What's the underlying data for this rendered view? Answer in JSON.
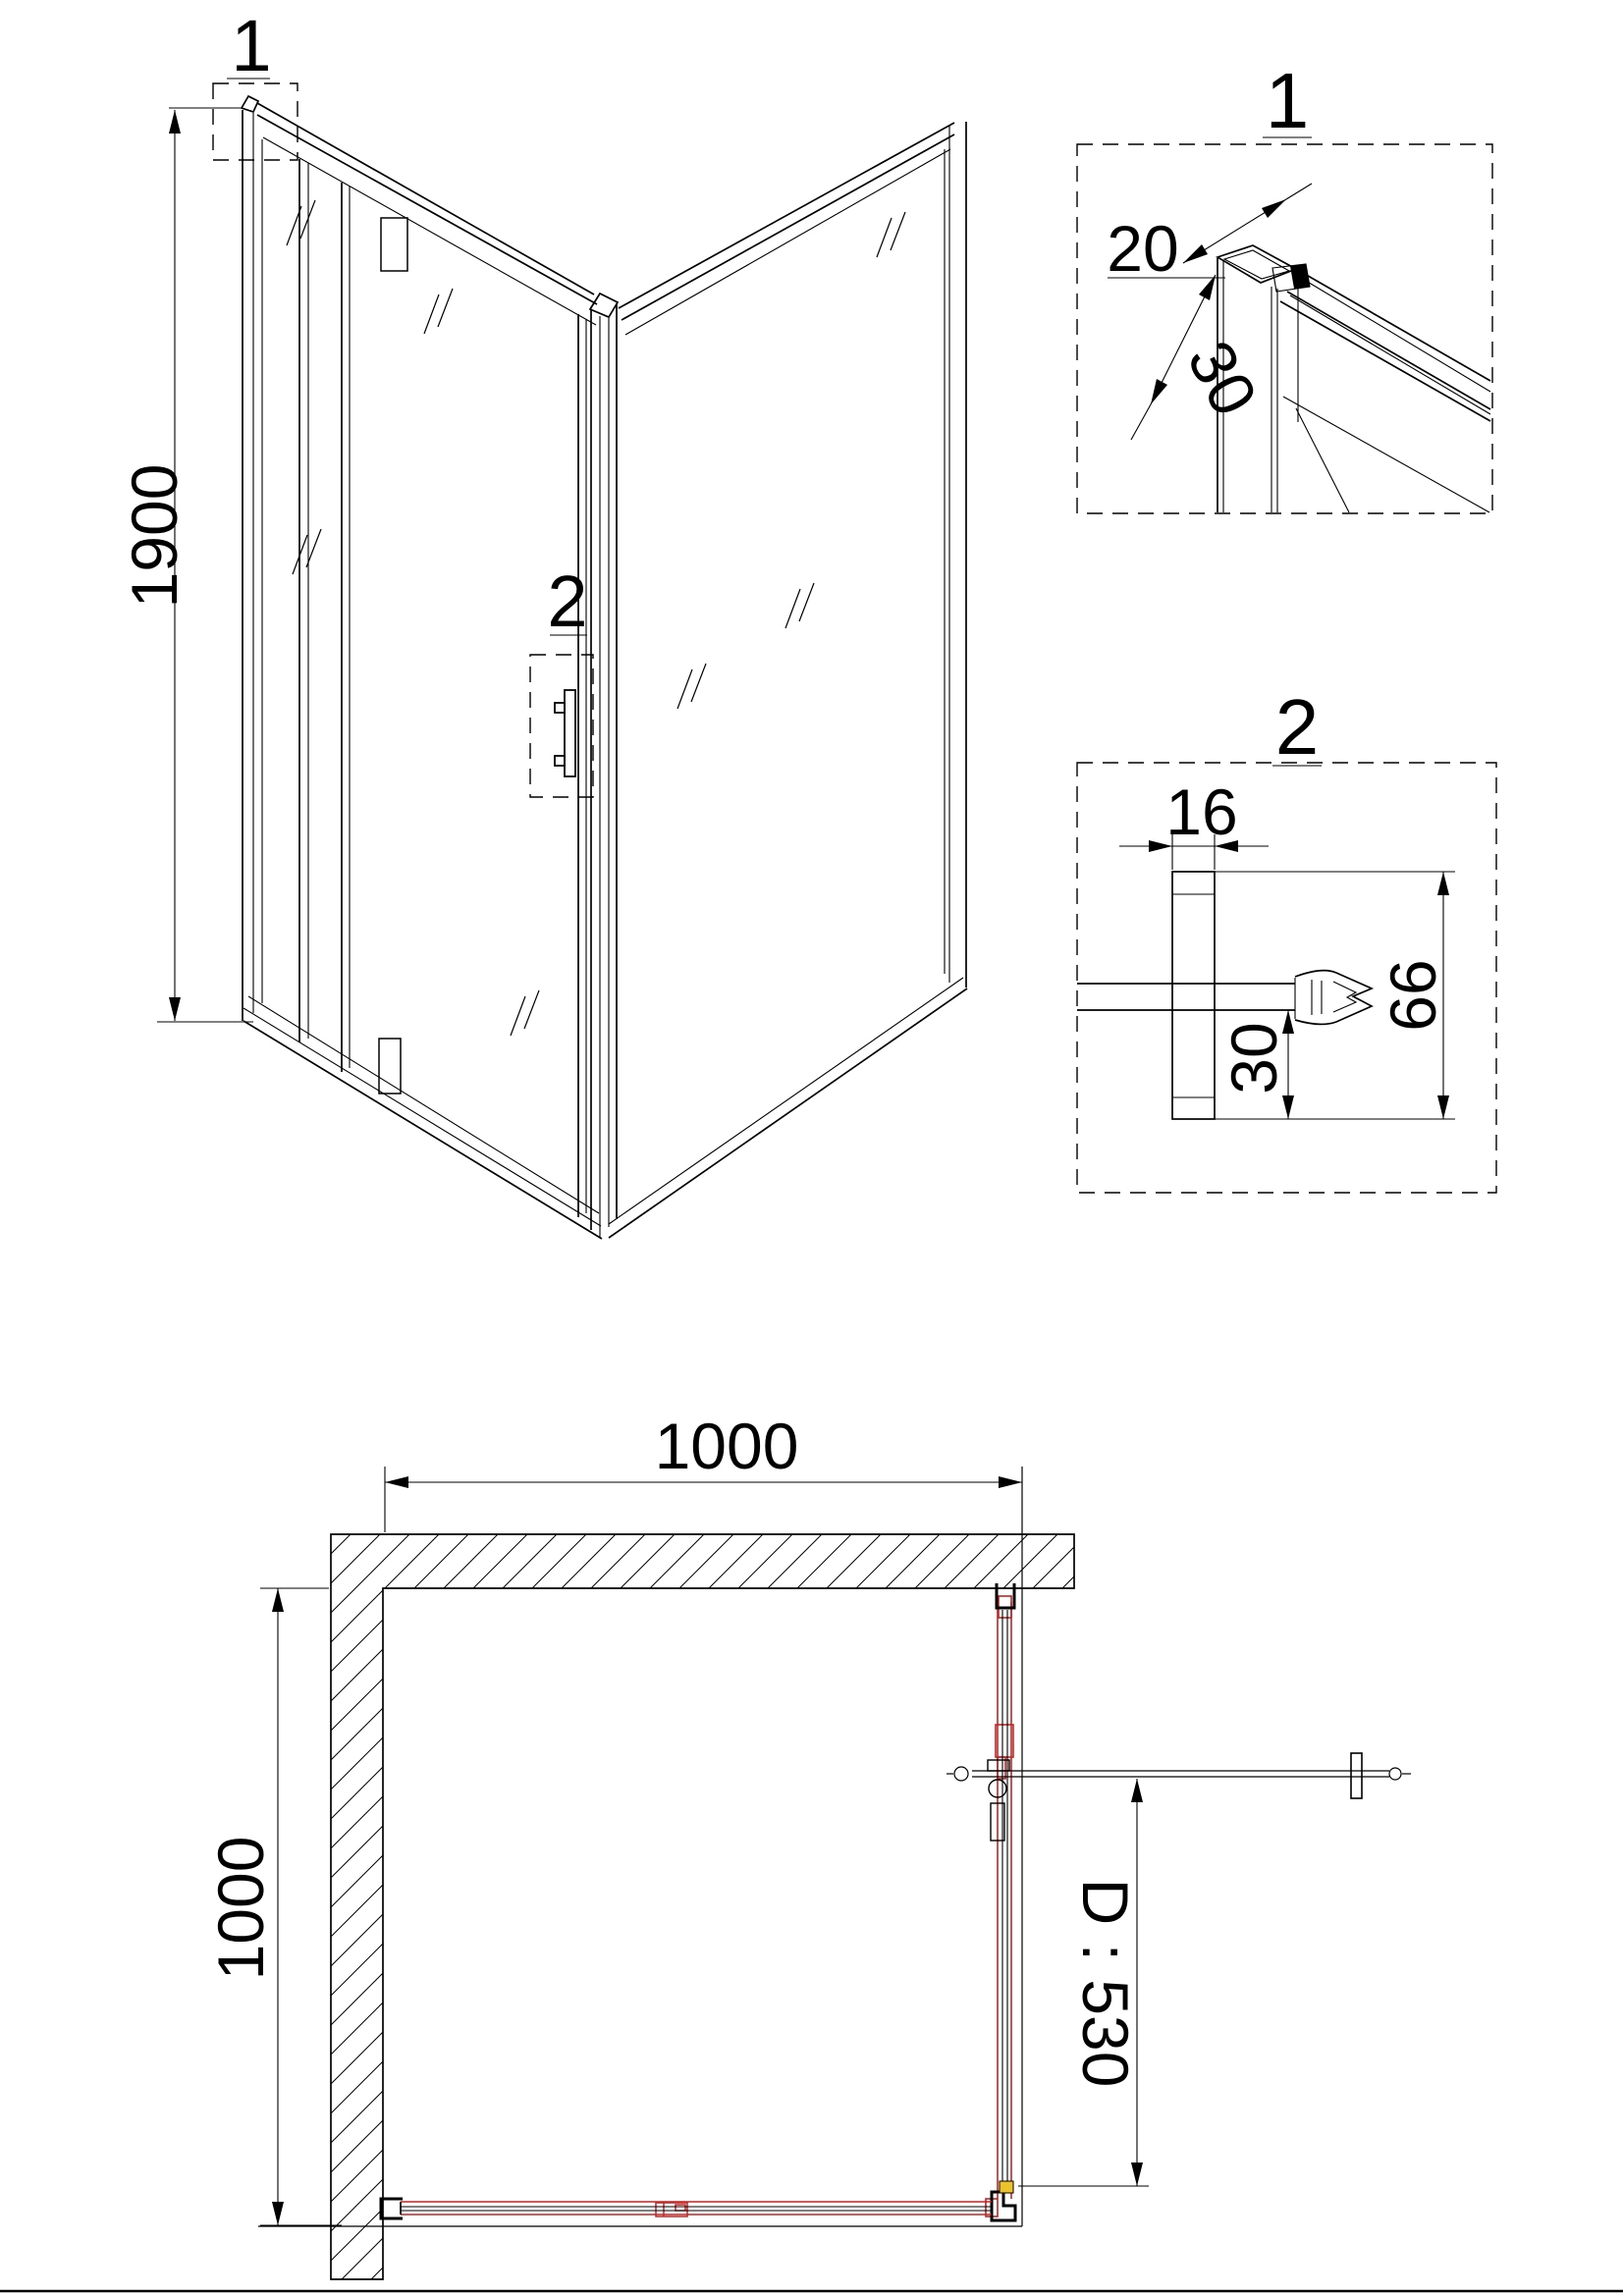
{
  "drawing": {
    "colors": {
      "line": "#000000",
      "accent_red": "#c32424",
      "accent_yellow": "#edc32c",
      "background": "#ffffff"
    },
    "perspective": {
      "callout_top": "1",
      "callout_handle": "2",
      "dim_height": "1900"
    },
    "detail_1": {
      "title": "1",
      "dim_profile_width": "20",
      "dim_profile_depth": "30"
    },
    "detail_2": {
      "title": "2",
      "dim_wall_profile_width": "16",
      "dim_lower_offset": "30",
      "dim_profile_height": "66"
    },
    "plan": {
      "dim_width": "1000",
      "dim_depth": "1000",
      "dim_door": "D : 530"
    }
  }
}
